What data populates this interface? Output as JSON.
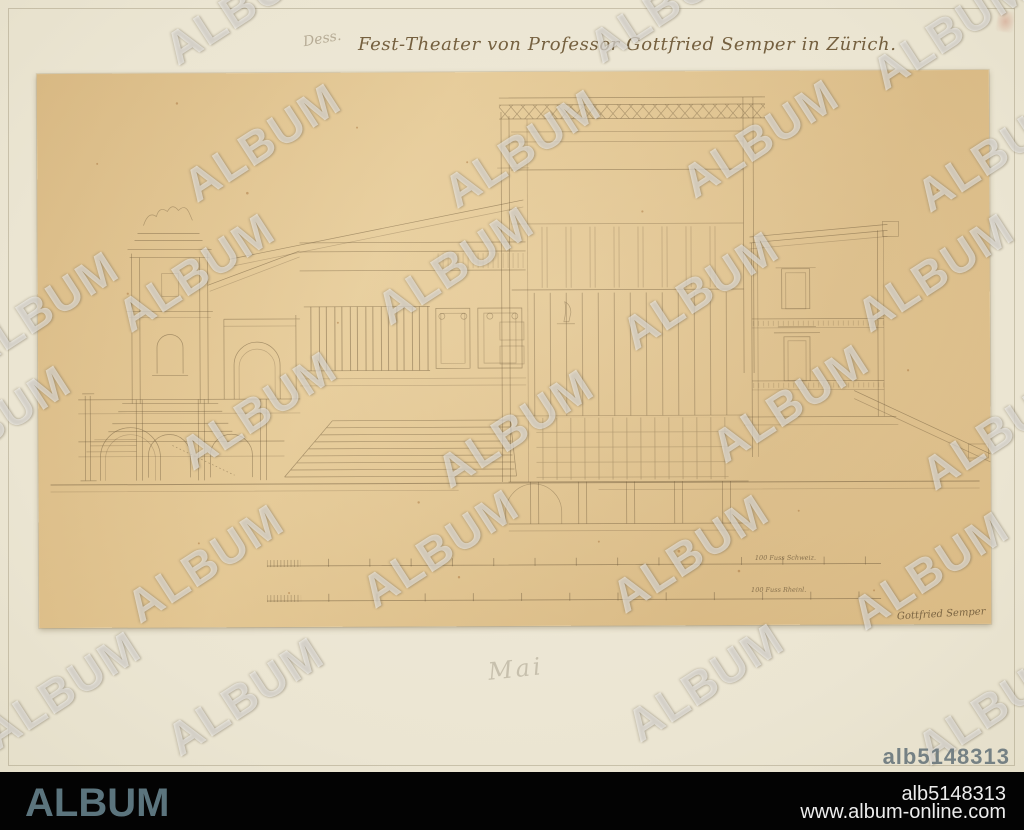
{
  "watermark": {
    "text": "ALBUM"
  },
  "photo": {
    "title_inscription": "Fest-Theater von Professor Gottfried Semper in Zürich.",
    "pencil_note_top": "Dess.",
    "pencil_note_bottom": "Mai",
    "colors": {
      "mount_board": "#ebe5d2",
      "drawing_paper": "#e2c693",
      "ink": "#6b573a",
      "footer_background": "#000000",
      "album_logo": "#5b747d",
      "id_overlay": "#6c797e",
      "watermark": "rgba(255,255,255,0.52)"
    }
  },
  "drawing": {
    "scale_label_upper": "100 Fuss Schweiz.",
    "scale_label_lower": "100 Fuss Rheinl.",
    "signature": "Gottfried Semper"
  },
  "overlay": {
    "image_id": "alb5148313"
  },
  "footer": {
    "logo": "ALBUM",
    "image_id": "alb5148313",
    "website": "www.album-online.com"
  }
}
